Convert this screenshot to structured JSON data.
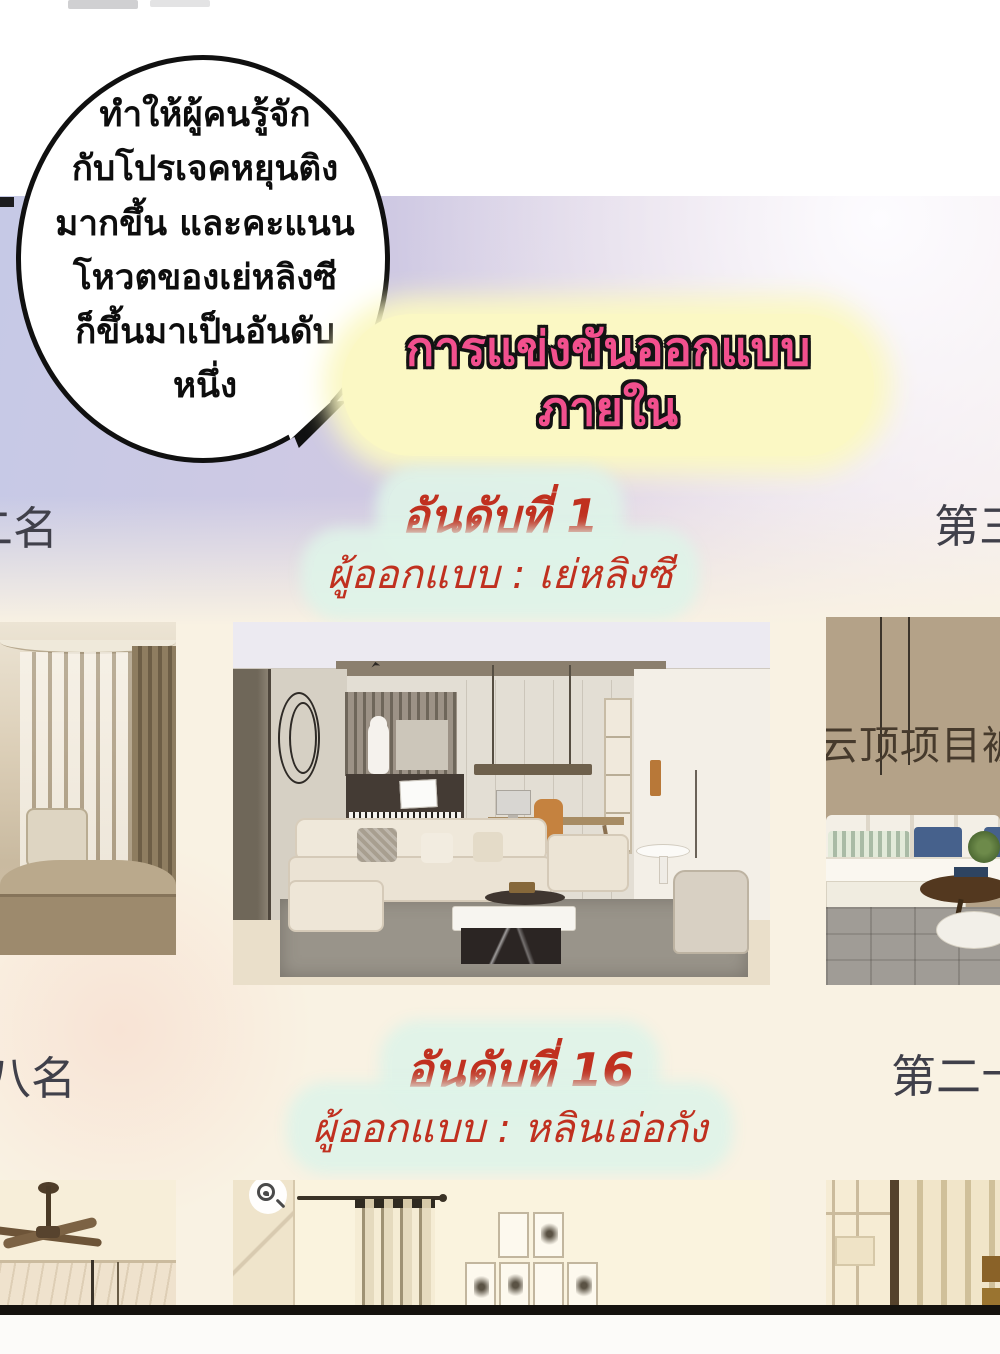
{
  "bubble": {
    "lines": [
      "ทำให้ผู้คนรู้จัก",
      "กับโปรเจคหยุนติง",
      "มากขึ้น และคะแนน",
      "โหวตของเย่หลิงซี",
      "ก็ขึ้นมาเป็นอันดับ",
      "หนึ่ง"
    ]
  },
  "title": {
    "line1": "การแข่งขันออกแบบ",
    "line2": "ภายใน"
  },
  "rank1": {
    "rank_label": "อันดับที่ 1",
    "designer_label": "ผู้ออกแบบ : เย่หลิงซี",
    "left_partial_label": "二名",
    "right_partial_label": "第三"
  },
  "rank16": {
    "rank_label": "อันดับที่ 16",
    "designer_label": "ผู้ออกแบบ : หลินเอ่อกัง",
    "left_partial_label": "八名",
    "right_partial_label": "第二十"
  },
  "overlay": {
    "watermark_text": "云顶项目被"
  },
  "icons": {
    "image_search_badge": "🔍"
  },
  "colors": {
    "title_text": "#f2508e",
    "title_glow": "#fbf8c4",
    "rank_text": "#c0301f",
    "rank_glow": "#def3e8",
    "side_label": "#40404a",
    "background_lavender": "#c6c9e6",
    "background_cream": "#f9f2e3"
  }
}
